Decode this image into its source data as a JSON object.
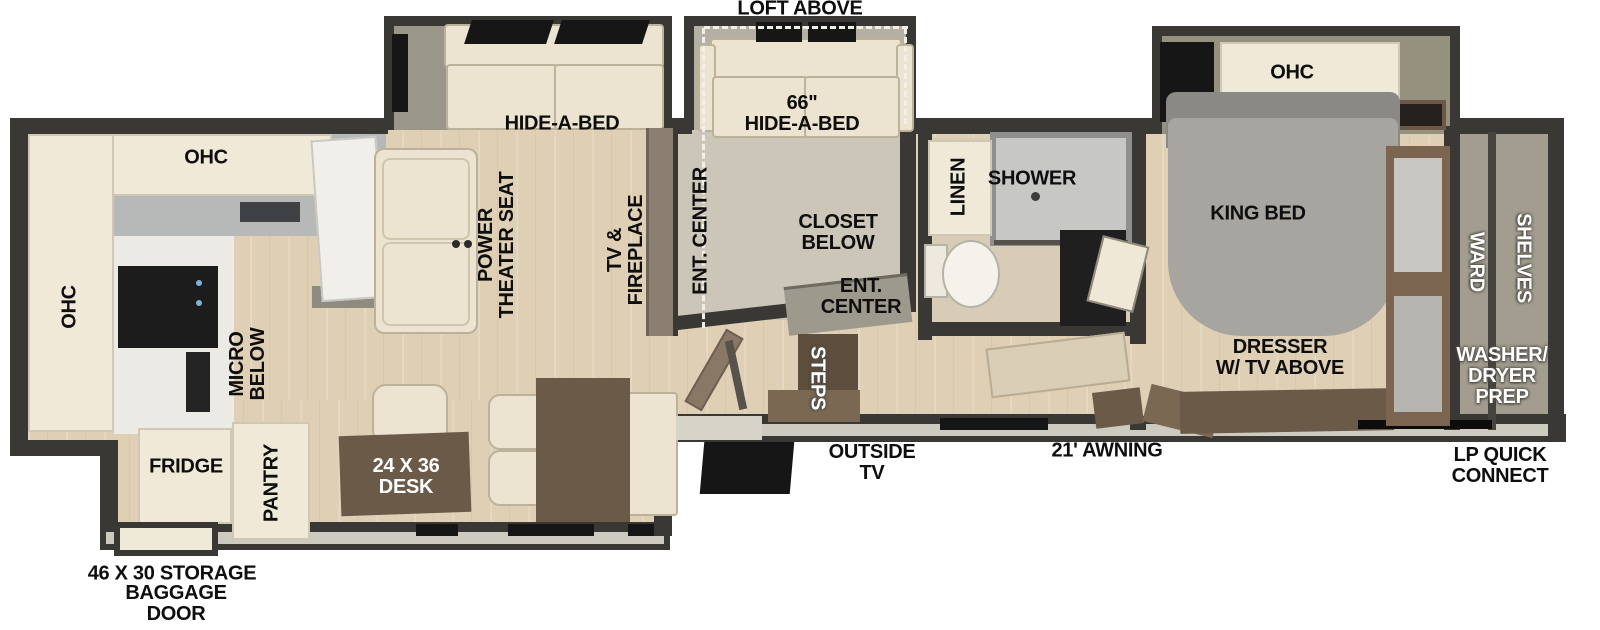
{
  "colors": {
    "wall": "#3a3835",
    "wall_light_edge": "#cdcabf",
    "floor_wood": "#decfb5",
    "cabinet_cream": "#f0e9d7",
    "slide_gray": "#9b968a",
    "counter_gray": "#b7b9b9",
    "counter_marble": "#eceae4",
    "furniture_brown": "#6b5a48",
    "steps_brown": "#5e4e3e",
    "tv_wall_brown": "#8a7f70",
    "shower_gray": "#c7c7c5",
    "bed_gray": "#a7a5a0",
    "closet_taupe": "#a29d8e",
    "appliance_black": "#1c1c1c",
    "label_black": "#0e0e0e",
    "label_white": "#ffffff"
  },
  "floorplan": {
    "exterior": {
      "loft_above": "LOFT ABOVE",
      "storage": "46 X 30 STORAGE",
      "baggage_door": "BAGGAGE\nDOOR",
      "outside_tv": "OUTSIDE\nTV",
      "awning": "21' AWNING",
      "lp_quick_connect": "LP QUICK\nCONNECT"
    },
    "kitchen": {
      "ohc_top": "OHC",
      "ohc_side": "OHC",
      "micro_below": "MICRO\nBELOW",
      "fridge": "FRIDGE",
      "pantry": "PANTRY",
      "desk": "24 X 36\nDESK"
    },
    "living_room": {
      "hide_a_bed": "HIDE-A-BED",
      "power_theater_seat": "POWER\nTHEATER SEAT",
      "tv_fireplace": "TV &\nFIREPLACE",
      "steps": "STEPS"
    },
    "loft_room": {
      "hide_a_bed_66": "66\"\nHIDE-A-BED",
      "ent_center_side": "ENT. CENTER",
      "closet_below": "CLOSET\nBELOW",
      "ent_center_front": "ENT.\nCENTER"
    },
    "bathroom": {
      "linen": "LINEN",
      "shower": "SHOWER"
    },
    "bedroom": {
      "ohc": "OHC",
      "king_bed": "KING BED",
      "dresser": "DRESSER\nW/ TV ABOVE"
    },
    "front_closet": {
      "ward": "WARD",
      "shelves": "SHELVES",
      "washer_dryer_prep": "WASHER/\nDRYER\nPREP"
    }
  }
}
